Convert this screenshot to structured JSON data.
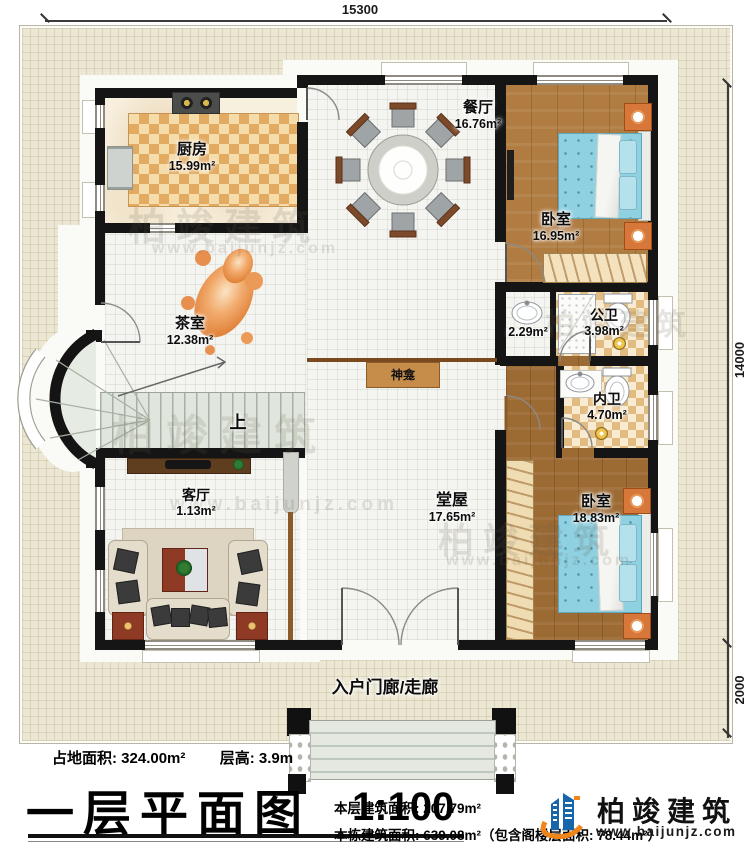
{
  "plan": {
    "title": "一层平面图",
    "scale": "1:100",
    "site_area": "占地面积: 324.00m²",
    "floor_height": "层高: 3.9m",
    "floor_area": "本层建筑面积: 207.79m²",
    "building_area": "本栋建筑面积: 639.08m²（包含阁楼层面积: 78.44m²）"
  },
  "dimensions": {
    "top": "15300",
    "right_main": "14000",
    "right_porch": "2000"
  },
  "rooms": {
    "kitchen": {
      "name": "厨房",
      "area": "15.99m²"
    },
    "dining": {
      "name": "餐厅",
      "area": "16.76m²"
    },
    "bedroom1": {
      "name": "卧室",
      "area": "16.95m²"
    },
    "vanity": {
      "area": "2.29m²"
    },
    "public_bath": {
      "name": "公卫",
      "area": "3.98m²"
    },
    "tea_room": {
      "name": "茶室",
      "area": "12.38m²"
    },
    "shrine": {
      "name": "神龛"
    },
    "private_bath": {
      "name": "内卫",
      "area": "4.70m²"
    },
    "living": {
      "name": "客厅",
      "area": "1.13m²"
    },
    "hall": {
      "name": "堂屋",
      "area": "17.65m²"
    },
    "bedroom2": {
      "name": "卧室",
      "area": "18.83m²"
    },
    "porch": {
      "name": "入户门廊/走廊"
    }
  },
  "stairs": {
    "up": "上"
  },
  "brand": {
    "name": "柏竣建筑",
    "website": "www.baijunjz.com"
  }
}
